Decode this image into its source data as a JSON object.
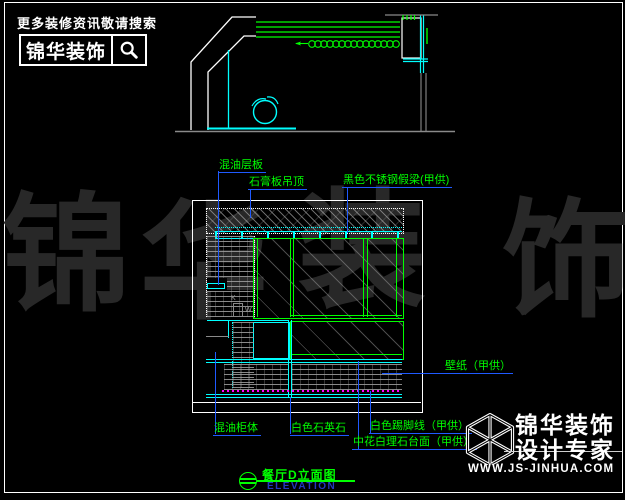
{
  "branding_top": {
    "slogan": "更多装修资讯敬请搜索",
    "logo_text": "锦华装饰"
  },
  "watermark": {
    "chars": [
      "锦",
      "华",
      "装",
      "饰"
    ]
  },
  "drawing_labels": {
    "ceiling_shelf": "混油层板",
    "gypsum_ceiling": "石膏板吊顶",
    "steel_fake_beam": "黑色不锈钢假梁(甲供)",
    "wallpaper": "壁纸（甲供）",
    "paint_cabinet": "混油柜体",
    "white_quartz": "白色石英石",
    "white_skirting": "白色踢脚线（甲供）",
    "marble_countertop": "中花白理石台面（甲供）"
  },
  "title_block": {
    "title": "餐厅D立面图",
    "subtitle": "ELEVATION"
  },
  "branding_bottom": {
    "company": "锦华装饰",
    "tagline": "设计专家",
    "website": "WWW.JS-JINHUA.COM"
  },
  "cad_detail": {
    "k": "K",
    "w": "W"
  },
  "colors": {
    "background": "#000000",
    "cad_green": "#00ff00",
    "cad_cyan": "#00ffff",
    "leader_blue": "#1f5aff",
    "magenta": "#ff00ff",
    "white": "#ffffff",
    "gray": "#8a8a8a",
    "watermark_gray": "#282828",
    "elevation_blue": "#2438c0"
  }
}
